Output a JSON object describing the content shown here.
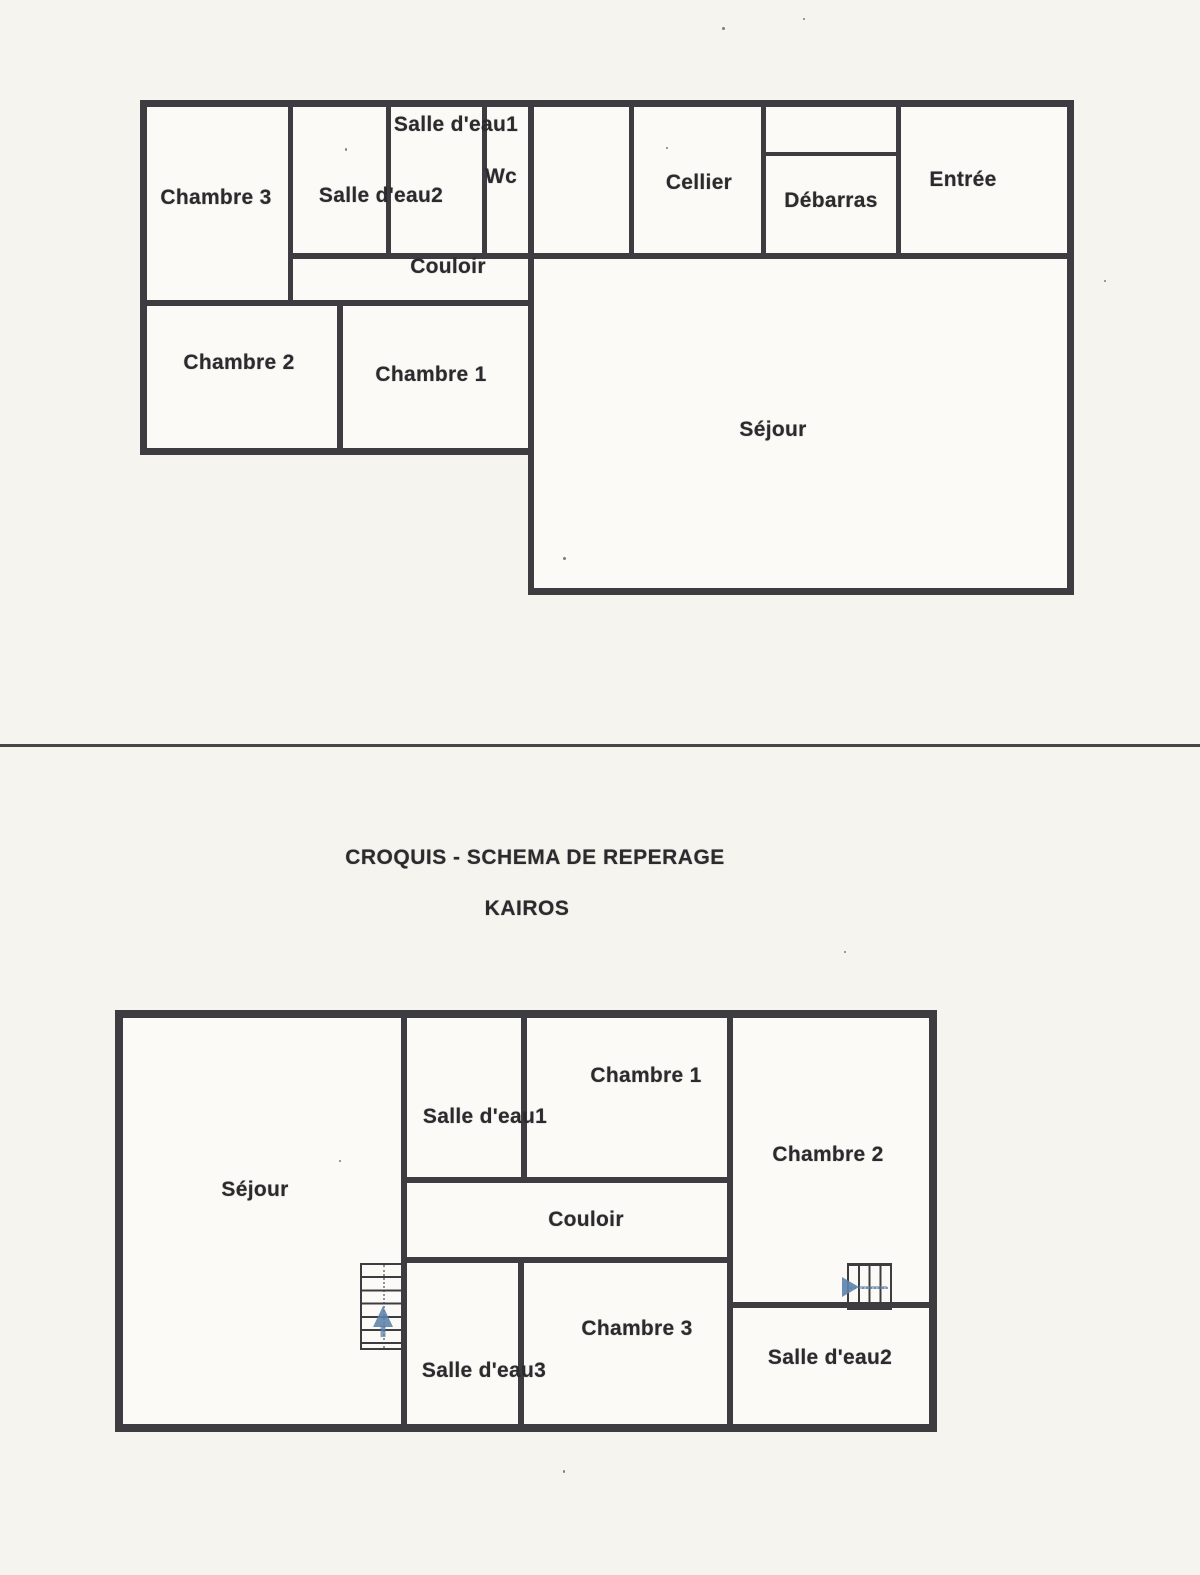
{
  "document": {
    "title_line1": "CROQUIS - SCHEMA DE REPERAGE",
    "title_line2": "KAIROS"
  },
  "colors": {
    "wall": "#3d3d41",
    "page_background": "#f5f4ef",
    "room_fill": "#fbfaf6",
    "text": "#2b2b2e",
    "stairs_arrow": "#5c82ab"
  },
  "icons": {
    "stairs_up": "staircase-with-up-arrow",
    "stairs_right": "staircase-with-right-arrow"
  },
  "plan1": {
    "rooms": [
      {
        "id": "chambre3",
        "label": "Chambre 3"
      },
      {
        "id": "salle_deau2",
        "label": "Salle d'eau2"
      },
      {
        "id": "salle_deau1",
        "label": "Salle d'eau1"
      },
      {
        "id": "wc",
        "label": "Wc"
      },
      {
        "id": "cellier",
        "label": "Cellier"
      },
      {
        "id": "debarras",
        "label": "Débarras"
      },
      {
        "id": "entree",
        "label": "Entrée"
      },
      {
        "id": "couloir",
        "label": "Couloir"
      },
      {
        "id": "chambre2",
        "label": "Chambre 2"
      },
      {
        "id": "chambre1",
        "label": "Chambre 1"
      },
      {
        "id": "sejour",
        "label": "Séjour"
      }
    ]
  },
  "plan2": {
    "rooms": [
      {
        "id": "sejour",
        "label": "Séjour"
      },
      {
        "id": "salle_deau1",
        "label": "Salle d'eau1"
      },
      {
        "id": "chambre1",
        "label": "Chambre 1"
      },
      {
        "id": "chambre2",
        "label": "Chambre 2"
      },
      {
        "id": "couloir",
        "label": "Couloir"
      },
      {
        "id": "salle_deau3",
        "label": "Salle d'eau3"
      },
      {
        "id": "chambre3",
        "label": "Chambre 3"
      },
      {
        "id": "salle_deau2",
        "label": "Salle d'eau2"
      }
    ]
  }
}
